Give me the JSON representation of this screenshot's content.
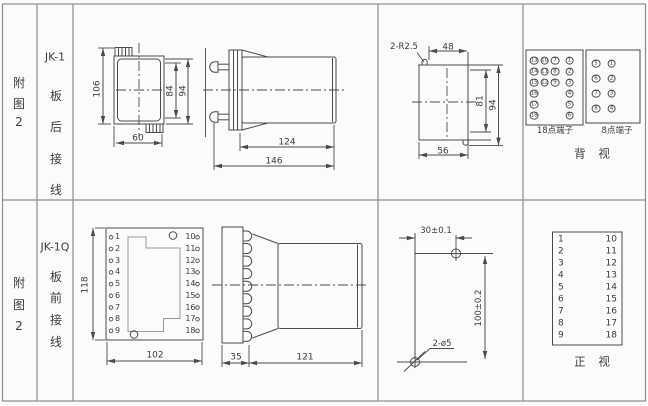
{
  "panel": {
    "row1": {
      "fig": [
        "附",
        "图",
        "2"
      ],
      "model": "JK-1",
      "wiring": [
        "板",
        "后",
        "接",
        "线"
      ],
      "dims": {
        "height": "106",
        "window_height": "84",
        "total_height": "94",
        "width": "60",
        "body_depth": "124",
        "total_depth": "146",
        "corner_radius": "2-R2.5",
        "top_width": "48",
        "cutout_inner_height": "81",
        "cutout_height": "94",
        "bottom_width": "56"
      },
      "terminal18": {
        "label": "18点端子",
        "rows": [
          [
            13,
            10,
            7,
            1
          ],
          [
            14,
            11,
            8,
            2
          ],
          [
            15,
            12,
            9,
            3
          ],
          [
            16,
            null,
            null,
            4
          ],
          [
            17,
            null,
            null,
            5
          ],
          [
            18,
            null,
            null,
            6
          ]
        ]
      },
      "terminal8": {
        "label": "8点端子",
        "rows": [
          [
            5,
            1
          ],
          [
            6,
            2
          ],
          [
            7,
            3
          ],
          [
            8,
            4
          ]
        ]
      },
      "view_label": "背 视"
    },
    "row2": {
      "fig": [
        "附",
        "图",
        "2"
      ],
      "model": "JK-1Q",
      "wiring": [
        "板",
        "前",
        "接",
        "线"
      ],
      "dims": {
        "height": "118",
        "width": "102",
        "panel_thickness": "35",
        "body_depth": "121",
        "hole_pitch_h": "30±0.1",
        "hole_pitch_v": "100±0.2",
        "hole_size": "2-ø5"
      },
      "left_terminals": [
        1,
        2,
        3,
        4,
        5,
        6,
        7,
        8,
        9
      ],
      "right_terminals": [
        10,
        11,
        12,
        13,
        14,
        15,
        16,
        17,
        18
      ],
      "table": {
        "left": [
          1,
          2,
          3,
          4,
          5,
          6,
          7,
          8,
          9
        ],
        "right": [
          10,
          11,
          12,
          13,
          14,
          15,
          16,
          17,
          18
        ]
      },
      "view_label": "正 视"
    }
  },
  "colors": {
    "line": "#4b4b4b",
    "grid": "#8d8d8d",
    "background": "#fbfbfb"
  }
}
